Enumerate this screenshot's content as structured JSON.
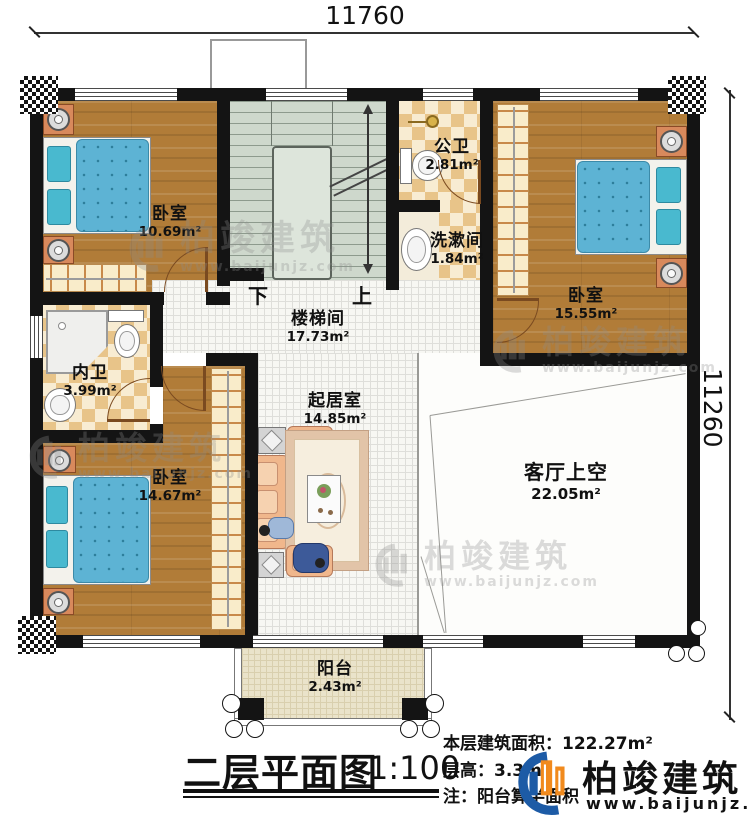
{
  "dimensions": {
    "top": "11760",
    "right": "11260"
  },
  "stairs": {
    "down": "下",
    "up": "上"
  },
  "rooms": {
    "bedroom1": {
      "label": "卧室",
      "area": "10.69m²"
    },
    "stairwell": {
      "label": "楼梯间",
      "area": "17.73m²"
    },
    "public_bath": {
      "label": "公卫",
      "area": "2.81m²"
    },
    "washroom": {
      "label": "洗漱间",
      "area": "1.84m²"
    },
    "bedroom2": {
      "label": "卧室",
      "area": "15.55m²"
    },
    "private_bath": {
      "label": "内卫",
      "area": "3.99m²"
    },
    "bedroom3": {
      "label": "卧室",
      "area": "14.67m²"
    },
    "living": {
      "label": "起居室",
      "area": "14.85m²"
    },
    "void": {
      "label": "客厅上空",
      "area": "22.05m²"
    },
    "balcony": {
      "label": "阳台",
      "area": "2.43m²"
    }
  },
  "title_block": {
    "title": "二层平面图",
    "scale": "1:100",
    "floor_area_label": "本层建筑面积：",
    "floor_area_value": "122.27m²",
    "floor_height_label": "层高：",
    "floor_height_value": "3.3m",
    "note": "注：阳台算半面积",
    "brand": "柏竣建筑",
    "website": "www.baijunjz.com"
  },
  "watermark": {
    "brand": "柏竣建筑",
    "website": "www.baijunjz.com"
  },
  "colors": {
    "wall": "#141414",
    "wood_floor": "#b17c38",
    "stair_floor": "#ced8cc",
    "checker_tile": "#e8c489",
    "hall_tile": "#f7f7f3",
    "balcony_floor": "#eae3ca",
    "mattress_blue": "#5db3d4",
    "furniture_peach": "#f0b78c",
    "brand_blue": "#1d5ba6",
    "brand_orange": "#f18a1d"
  }
}
